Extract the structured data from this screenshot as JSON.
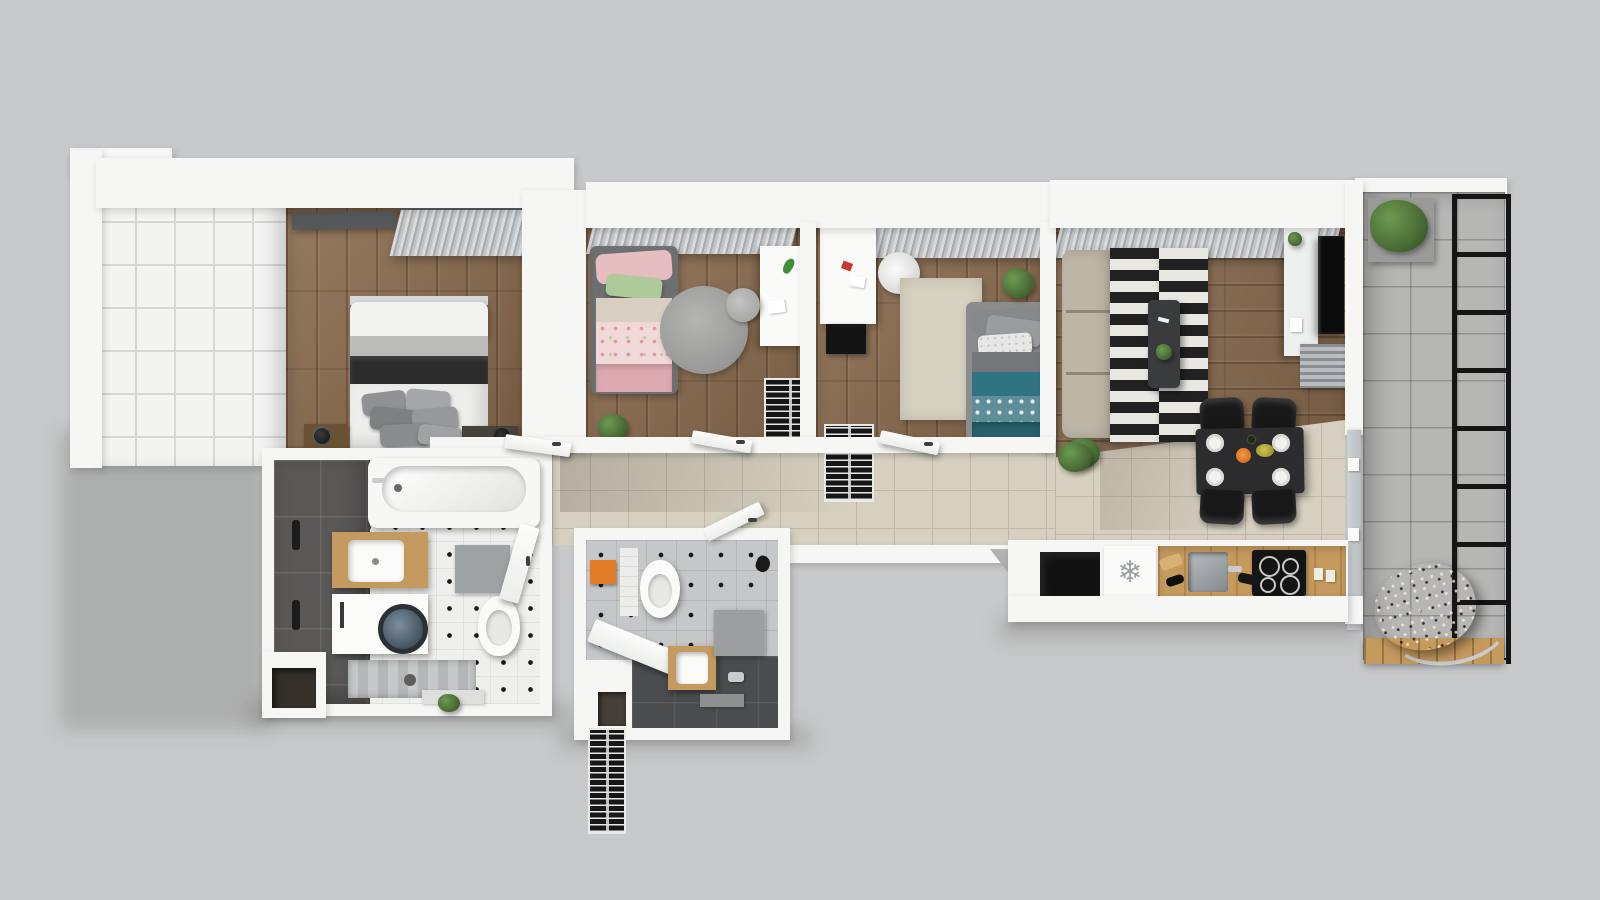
{
  "scene": {
    "type": "3D apartment floor plan, top-down axonometric render",
    "background": "#c8c9ca"
  },
  "icons": {
    "fridge_snowflake": "❄"
  },
  "palette": {
    "bg": "#c8c9ca",
    "wall": "#f6f6f5",
    "wood": "#8a6b4e",
    "woodLight": "#c59a5f",
    "woodDresser": "#6b5133",
    "tileHall": "#d7d0c1",
    "tileHallLine": "#bfb8aa",
    "concrete": "#b6b6b5",
    "darkTile": "#595857",
    "dotFloor": "#efefee",
    "dotColor": "#191919",
    "grayTileB2": "#c5c7c8",
    "darkFloorB2": "#4a4c4e",
    "panelLine": "#d6d6d3",
    "pelmet": "#55585b",
    "sofa": "#bdb5a6",
    "rugDark": "#212121",
    "rugLight": "#eae8e3",
    "rugRound": "#9d9d9b",
    "rugBeige": "#d6d0c0",
    "teal": "#2f7482",
    "tealDeep": "#27616d",
    "pink": "#e6bec2",
    "pinkLight": "#f1d9da",
    "pinkDeep": "#dfabb2",
    "greenPillow": "#aec99a",
    "charcoal": "#2c2c2c",
    "grayPillow": "#8f9193",
    "black": "#141414",
    "chrome": "#c9ccce",
    "plant": "#4d7038",
    "plantLight": "#6d9a52",
    "plantDark": "#2f4a22",
    "rattan": "#7a5a3b",
    "orangeBox": "#e07b28",
    "tvBlack": "#0b0b0c",
    "glass": "#ccd1d3"
  },
  "rooms": [
    {
      "name": "master-bedroom",
      "floor": "wood",
      "furniture": [
        "grid-wardrobe",
        "double-bed",
        "pillow-stack",
        "nightstand",
        "lamp",
        "bench",
        "curtains"
      ]
    },
    {
      "name": "kids-bedroom",
      "floor": "wood",
      "furniture": [
        "single-bed",
        "round-rug",
        "desk",
        "chair",
        "wardrobe",
        "plant",
        "curtains"
      ]
    },
    {
      "name": "third-bedroom",
      "floor": "wood",
      "furniture": [
        "single-bed",
        "rug",
        "desk",
        "egg-chair",
        "wardrobe",
        "plant",
        "curtains"
      ]
    },
    {
      "name": "living-dining",
      "floor": "wood+tile",
      "furniture": [
        "sofa",
        "striped-rug",
        "coffee-table",
        "tv-sideboard",
        "tv",
        "radiator",
        "dining-table",
        "dining-chairs",
        "plates",
        "curtains"
      ]
    },
    {
      "name": "kitchen",
      "floor": "tile",
      "furniture": [
        "fridge",
        "sink",
        "induction-hob",
        "counter",
        "bottles",
        "canisters"
      ]
    },
    {
      "name": "hallway",
      "floor": "beige-tile",
      "furniture": [
        "doors",
        "plant"
      ]
    },
    {
      "name": "bathroom-1",
      "floor": "dot-tile",
      "furniture": [
        "bathtub",
        "vanity-sink",
        "washing-machine",
        "toilet",
        "shower-tray",
        "bath-mat"
      ]
    },
    {
      "name": "bathroom-2",
      "floor": "dot-tile+dark-tile",
      "furniture": [
        "toilet",
        "vanity-sink",
        "shower-bench",
        "slatted-shelf",
        "detergent-box",
        "bath-mat"
      ]
    },
    {
      "name": "balcony",
      "floor": "concrete-tile",
      "furniture": [
        "planter",
        "metal-railing",
        "hanging-egg-chair",
        "wood-deck"
      ]
    }
  ]
}
